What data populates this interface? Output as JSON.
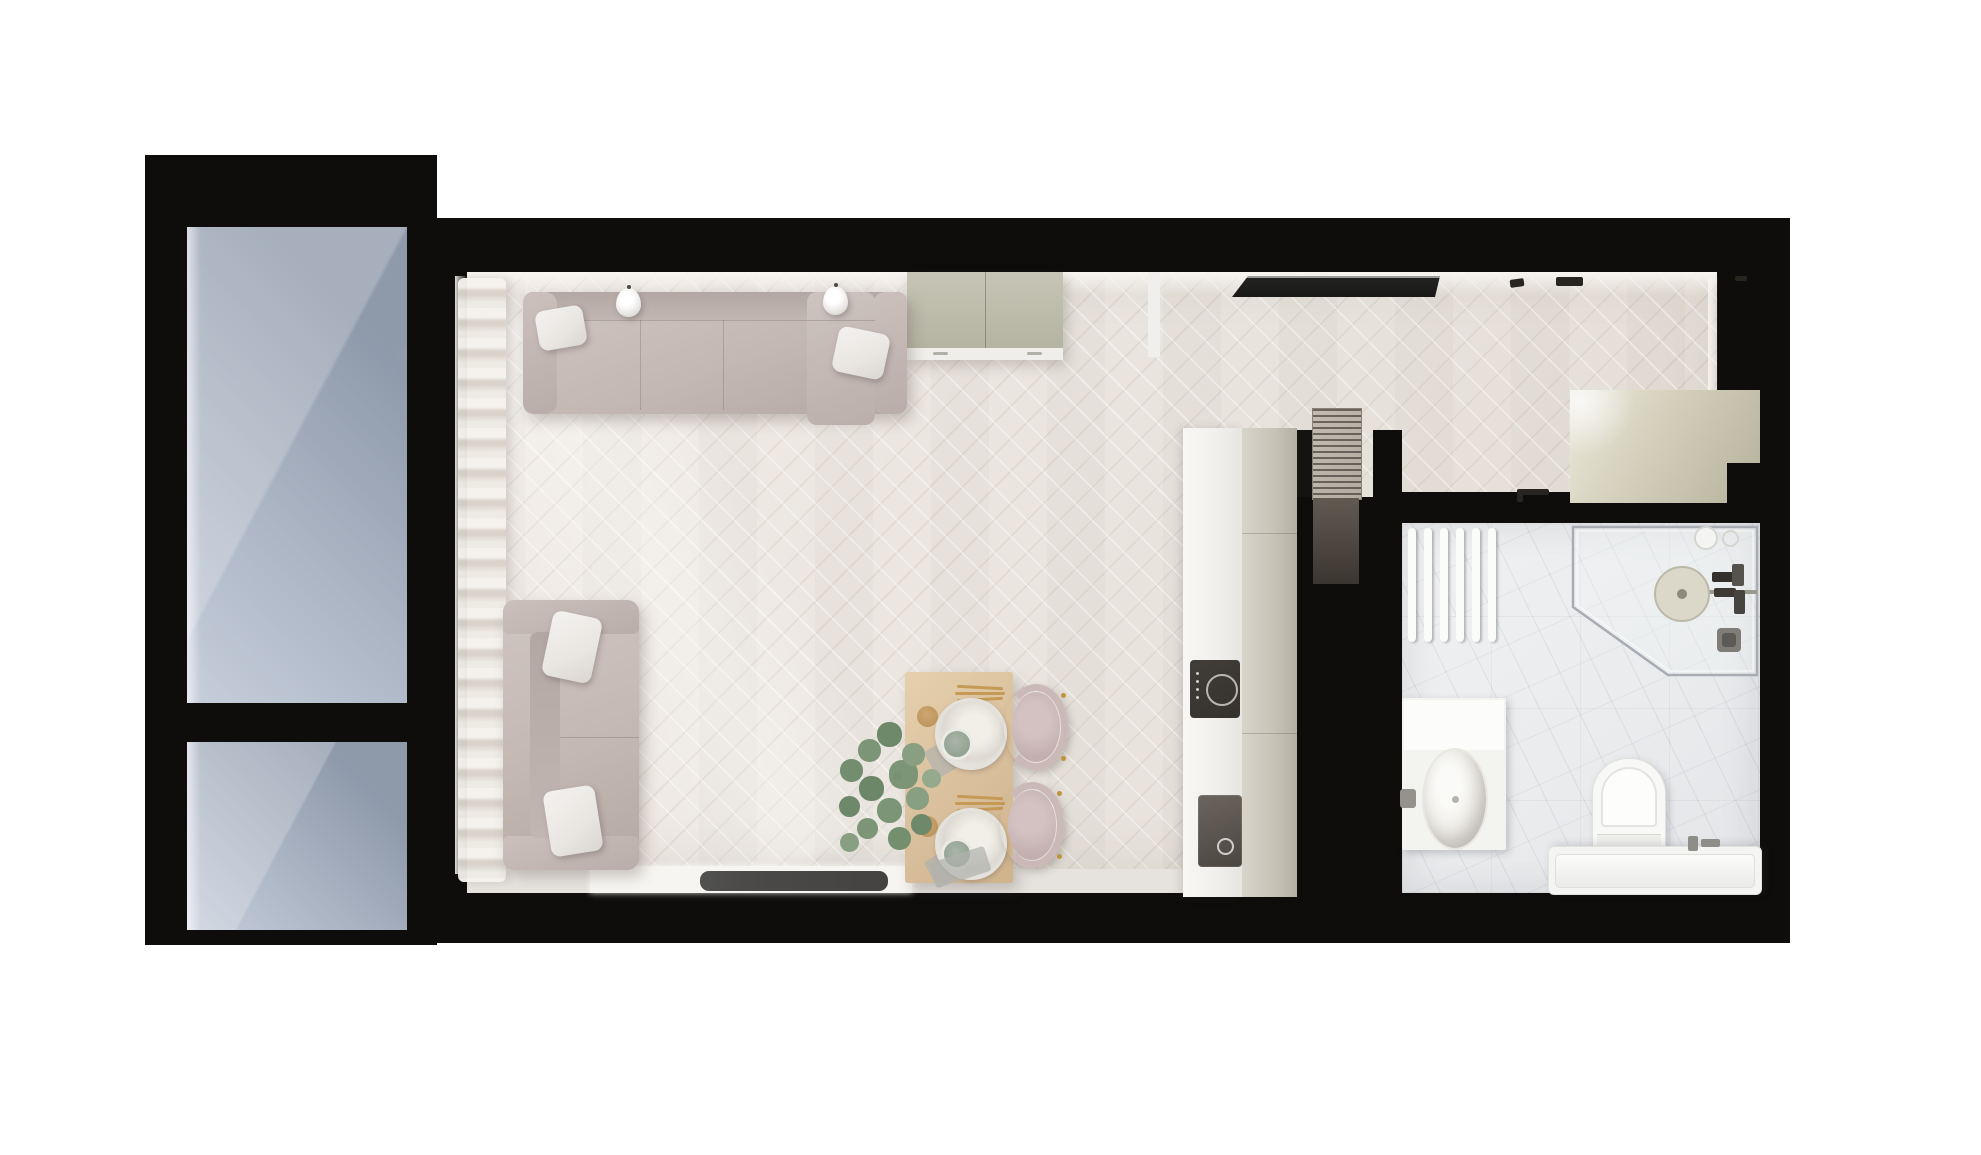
{
  "scene": {
    "type": "architectural-floor-plan-3d-render",
    "view": "top-down",
    "rooms": [
      "balcony",
      "living-room",
      "dining-area",
      "kitchen",
      "hallway",
      "bathroom"
    ]
  },
  "colors": {
    "wall": "#0e0d0b",
    "floor": "#e8e3dc",
    "floor_light": "#f1ece6",
    "marble": "#e9ebed",
    "glass": "#8e99aa",
    "glass_light": "#c6cedb",
    "fabric": "#c4b8b3",
    "pillow": "#e9e6e2",
    "sage": "#b5b4a3",
    "wood": "#d9bf9c",
    "chair": "#cbb9b8",
    "counter": "#f0efec",
    "cabinet": "#c8c4b8",
    "wardrobe": "#d3d0bb",
    "hob": "#35312d",
    "sink": "#4b4640",
    "mat": "#4a4947",
    "tv": "#191918",
    "louver": "#b1aba0",
    "fixture": "#fbfbf9"
  },
  "counts": {
    "pendant_lamps": 2,
    "sofa_top_seats": 3,
    "sofa_pillows": 4,
    "dining_chairs": 2,
    "place_settings": 2,
    "towel_radiator_bars": 6,
    "balcony_sections": 2
  }
}
